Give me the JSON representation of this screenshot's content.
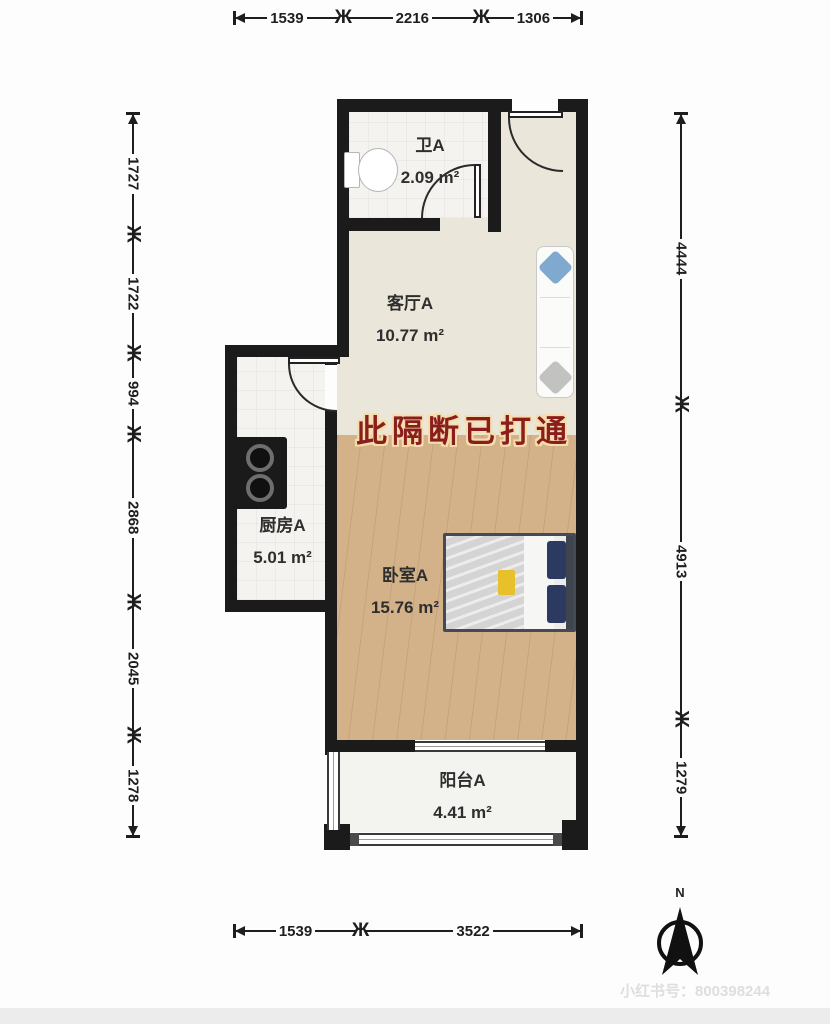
{
  "colors": {
    "wall": "#1b1b1b",
    "living_floor": "#ebe6da",
    "wood_floor": "#d3b28a",
    "tile_floor": "#f4f3f0",
    "balcony_floor": "#f3f3f0",
    "annotation_red": "#8a1e1e",
    "annotation_outline": "#f6ddab"
  },
  "icons": {
    "dim_tick": "Ж"
  },
  "dimensions": {
    "top": [
      "1539",
      "2216",
      "1306"
    ],
    "bottom": [
      "1539",
      "3522"
    ],
    "left": [
      "1727",
      "1722",
      "994",
      "2868",
      "2045",
      "1278"
    ],
    "right": [
      "4444",
      "4913",
      "1279"
    ]
  },
  "rooms": {
    "bathroom": {
      "name": "卫A",
      "area": "2.09 m²"
    },
    "living_room": {
      "name": "客厅A",
      "area": "10.77 m²"
    },
    "kitchen": {
      "name": "厨房A",
      "area": "5.01 m²"
    },
    "bedroom": {
      "name": "卧室A",
      "area": "15.76 m²"
    },
    "balcony": {
      "name": "阳台A",
      "area": "4.41 m²"
    }
  },
  "annotation": {
    "text": "此隔断已打通"
  },
  "compass": {
    "label": "N"
  },
  "footer": {
    "id_text": "小红书号：800398244"
  }
}
